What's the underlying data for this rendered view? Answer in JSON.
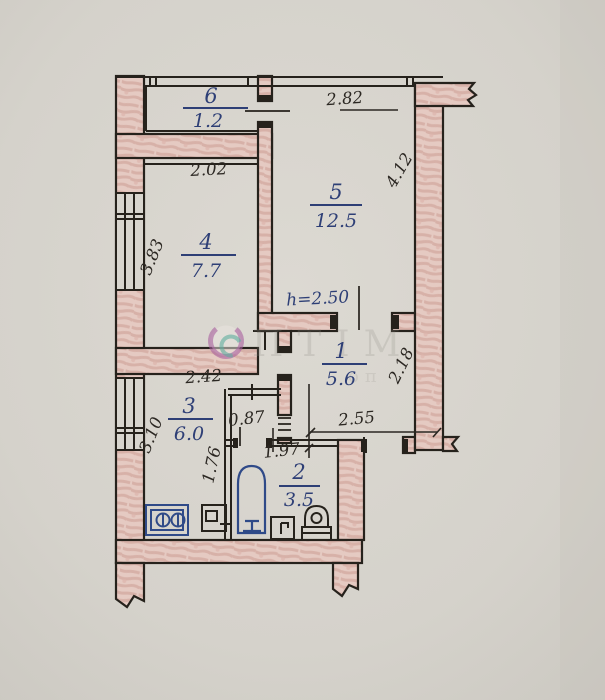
{
  "plan": {
    "title": "hand-drawn apartment floor plan",
    "rooms": [
      {
        "number": "6",
        "area": "1.2"
      },
      {
        "number": "5",
        "area": "12.5"
      },
      {
        "number": "4",
        "area": "7.7"
      },
      {
        "number": "1",
        "area": "5.6"
      },
      {
        "number": "3",
        "area": "6.0"
      },
      {
        "number": "2",
        "area": "3.5"
      }
    ],
    "dims": {
      "w_room5": "2.82",
      "w_room4": "2.02",
      "d_room4": "3.83",
      "d_room5": "4.12",
      "h_note": "h=2.50",
      "w_room3": "2.42",
      "d_room3": "3.10",
      "w_pass": "0.87",
      "d_room2": "1.76",
      "w_room2": "1.97",
      "w_room1": "2.55",
      "d_room1": "2.18"
    },
    "watermark": {
      "word": "ПТІМ",
      "word2": "оп"
    },
    "colors": {
      "paper": "#d6d3cc",
      "ink": "#26221c",
      "blue_ink": "#2e3f76",
      "fixture_blue": "#2f4a88",
      "wall_pink": "#e5cac2",
      "wall_pink_streak": "#d3a89e",
      "watermark_purple": "#a85f9f",
      "watermark_teal": "#5fae9f"
    }
  }
}
